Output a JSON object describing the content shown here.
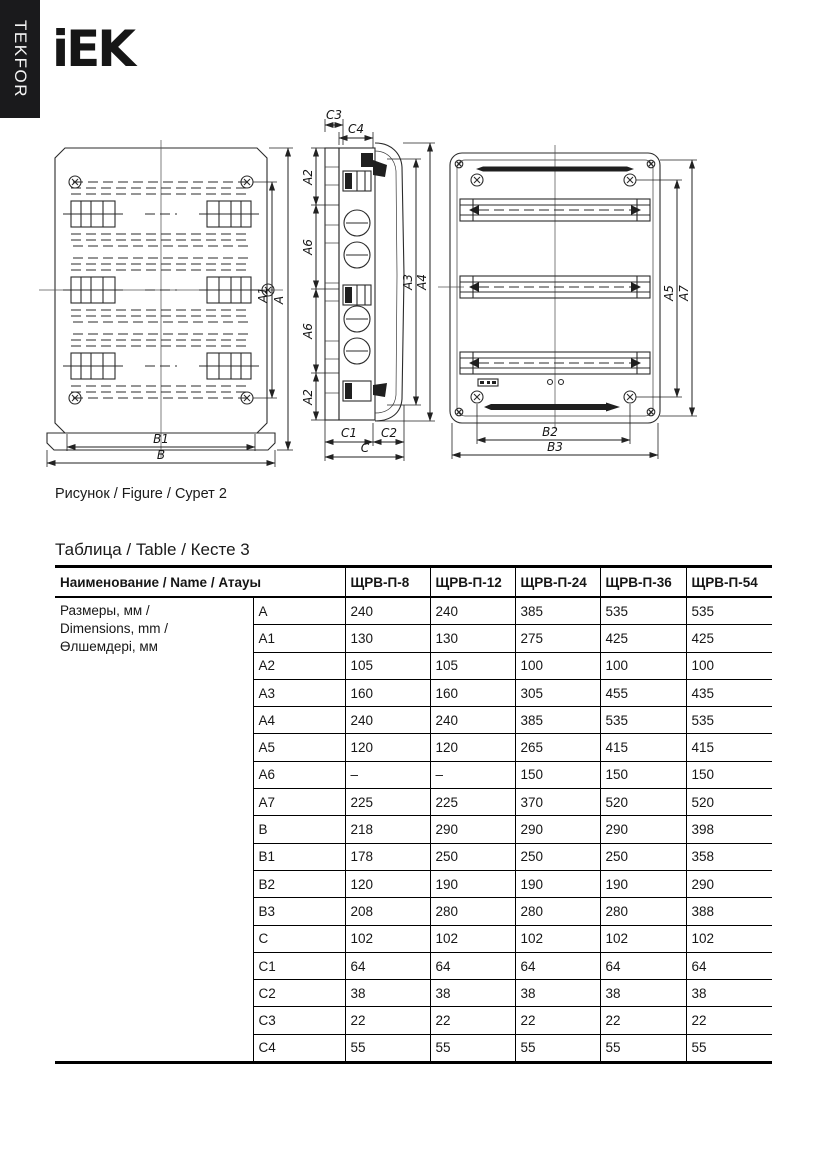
{
  "brand": {
    "sidebar_label": "TEKFOR",
    "logo_text": "iEK"
  },
  "figure": {
    "caption": "Рисунок / Figure / Сурет 2",
    "front_view": {
      "dim_labels": {
        "A": "A",
        "A1": "A1",
        "B": "B",
        "B1": "B1"
      }
    },
    "side_view": {
      "dim_labels": {
        "C3": "C3",
        "C4": "C4",
        "A2_top": "A2",
        "A6_upper": "A6",
        "A6_lower": "A6",
        "A2_bottom": "A2",
        "A3": "A3",
        "A4": "A4",
        "C1": "C1",
        "C2": "C2",
        "C": "C"
      }
    },
    "back_view": {
      "dim_labels": {
        "A5": "A5",
        "A7": "A7",
        "B2": "B2",
        "B3": "B3"
      }
    }
  },
  "table": {
    "caption": "Таблица / Table / Кесте 3",
    "name_header": "Наименование / Name / Атауы",
    "model_headers": [
      "ЩРВ-П-8",
      "ЩРВ-П-12",
      "ЩРВ-П-24",
      "ЩРВ-П-36",
      "ЩРВ-П-54"
    ],
    "group_label_lines": [
      "Размеры, мм /",
      "Dimensions, mm /",
      "Өлшемдері, мм"
    ],
    "rows": [
      {
        "dim": "A",
        "values": [
          "240",
          "240",
          "385",
          "535",
          "535"
        ]
      },
      {
        "dim": "A1",
        "values": [
          "130",
          "130",
          "275",
          "425",
          "425"
        ]
      },
      {
        "dim": "A2",
        "values": [
          "105",
          "105",
          "100",
          "100",
          "100"
        ]
      },
      {
        "dim": "A3",
        "values": [
          "160",
          "160",
          "305",
          "455",
          "435"
        ]
      },
      {
        "dim": "A4",
        "values": [
          "240",
          "240",
          "385",
          "535",
          "535"
        ]
      },
      {
        "dim": "A5",
        "values": [
          "120",
          "120",
          "265",
          "415",
          "415"
        ]
      },
      {
        "dim": "A6",
        "values": [
          "–",
          "–",
          "150",
          "150",
          "150"
        ]
      },
      {
        "dim": "A7",
        "values": [
          "225",
          "225",
          "370",
          "520",
          "520"
        ]
      },
      {
        "dim": "B",
        "values": [
          "218",
          "290",
          "290",
          "290",
          "398"
        ]
      },
      {
        "dim": "B1",
        "values": [
          "178",
          "250",
          "250",
          "250",
          "358"
        ]
      },
      {
        "dim": "B2",
        "values": [
          "120",
          "190",
          "190",
          "190",
          "290"
        ]
      },
      {
        "dim": "B3",
        "values": [
          "208",
          "280",
          "280",
          "280",
          "388"
        ]
      },
      {
        "dim": "C",
        "values": [
          "102",
          "102",
          "102",
          "102",
          "102"
        ]
      },
      {
        "dim": "C1",
        "values": [
          "64",
          "64",
          "64",
          "64",
          "64"
        ]
      },
      {
        "dim": "C2",
        "values": [
          "38",
          "38",
          "38",
          "38",
          "38"
        ]
      },
      {
        "dim": "C3",
        "values": [
          "22",
          "22",
          "22",
          "22",
          "22"
        ]
      },
      {
        "dim": "C4",
        "values": [
          "55",
          "55",
          "55",
          "55",
          "55"
        ]
      }
    ]
  }
}
